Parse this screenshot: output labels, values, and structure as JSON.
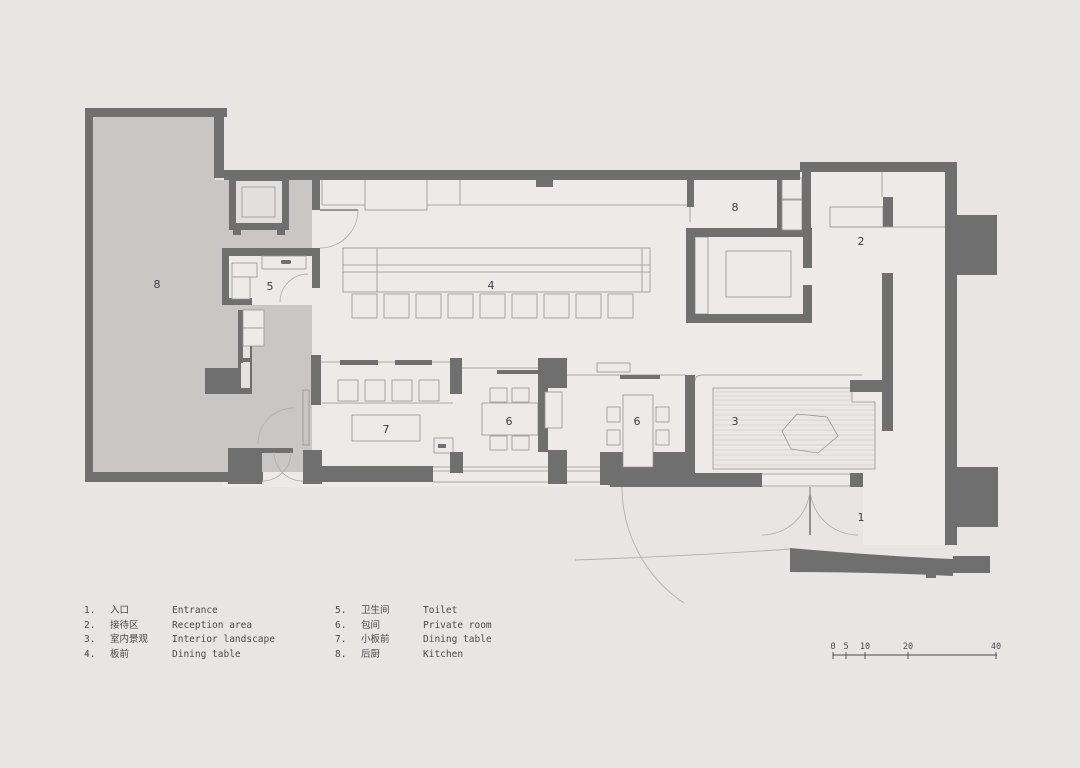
{
  "title": "restaurant floor plan",
  "colors": {
    "background": "#e8e6e3",
    "interior": "#edebe8",
    "kitchen_fill": "#c9c7c4",
    "wall": "#6f6f6f",
    "line": "#97948f",
    "text": "#4b4b4b"
  },
  "plan": {
    "labels": [
      {
        "room": "entrance",
        "text": "1"
      },
      {
        "room": "reception-area",
        "text": "2"
      },
      {
        "room": "interior-landscape",
        "text": "3"
      },
      {
        "room": "dining-counter",
        "text": "4"
      },
      {
        "room": "toilet",
        "text": "5"
      },
      {
        "room": "private-room-1",
        "text": "6"
      },
      {
        "room": "private-room-2",
        "text": "6"
      },
      {
        "room": "small-dining-counter",
        "text": "7"
      },
      {
        "room": "kitchen-left",
        "text": "8"
      },
      {
        "room": "kitchen-top",
        "text": "8"
      }
    ]
  },
  "legend": {
    "items": [
      {
        "num": "1.",
        "zh": "入口",
        "en": "Entrance"
      },
      {
        "num": "2.",
        "zh": "接待区",
        "en": "Reception area"
      },
      {
        "num": "3.",
        "zh": "室内景观",
        "en": "Interior landscape"
      },
      {
        "num": "4.",
        "zh": "板前",
        "en": "Dining table"
      },
      {
        "num": "5.",
        "zh": "卫生间",
        "en": "Toilet"
      },
      {
        "num": "6.",
        "zh": "包间",
        "en": "Private room"
      },
      {
        "num": "7.",
        "zh": "小板前",
        "en": "Dining table"
      },
      {
        "num": "8.",
        "zh": "后厨",
        "en": "Kitchen"
      }
    ]
  },
  "scale_bar": {
    "labels": [
      "0",
      "5",
      "10",
      "20",
      "40"
    ]
  }
}
